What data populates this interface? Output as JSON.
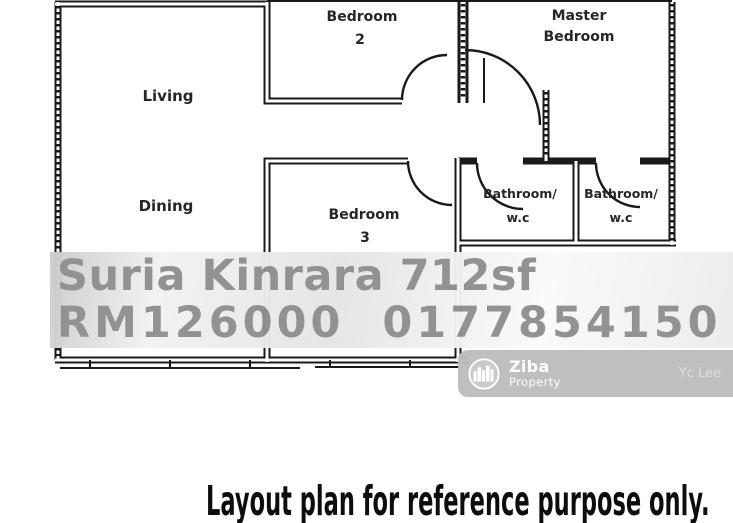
{
  "floor_plan": {
    "wall_color": "#1a1a1a",
    "label_color": "#262626",
    "labels": {
      "living": "Living",
      "dining": "Dining",
      "bedroom2_line1": "Bedroom",
      "bedroom2_line2": "2",
      "master_line1": "Master",
      "master_line2": "Bedroom",
      "bedroom3_line1": "Bedroom",
      "bedroom3_line2": "3",
      "bathroom1_line1": "Bathroom/",
      "bathroom1_line2": "w.c",
      "bathroom2_line1": "Bathroom/",
      "bathroom2_line2": "w.c"
    }
  },
  "listing_overlay": {
    "line1": "Suria Kinrara 712sf",
    "line2": "RM126000  0177854150",
    "text_color": "#8f8f8f"
  },
  "watermark": {
    "logo_icon": "city-skyline-icon",
    "brand_name": "Ziba",
    "brand_subtitle": "Property",
    "agent_name": "Yc Lee",
    "strip_color": "#bdbdbd"
  },
  "caption": {
    "text": "Layout plan for reference purpose only.",
    "color": "#0d0d0d"
  }
}
